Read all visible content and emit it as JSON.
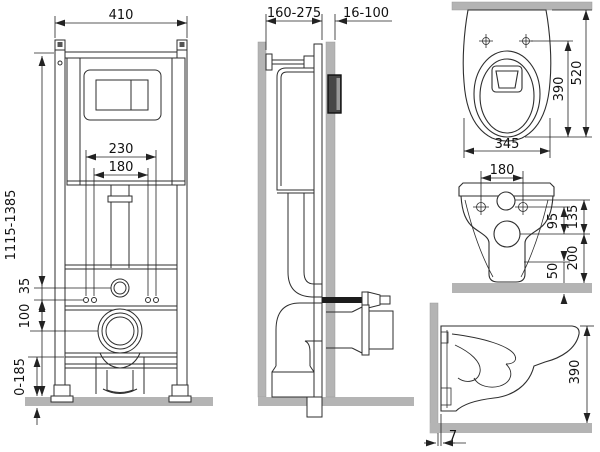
{
  "colors": {
    "line": "#2e2e2e",
    "dim_line": "#222222",
    "text": "#111111",
    "wall_fill": "#b4b4b4",
    "floor_fill": "#b4b4b4",
    "access_box_fill": "#474747",
    "access_box_highlight": "#9a9a9a",
    "background": "#ffffff"
  },
  "views": {
    "frame_front": {
      "dims": {
        "width": "410",
        "bolt_span_outer": "230",
        "bolt_span_inner": "180",
        "height_range": "1115-1385",
        "inlet_to_bolts": "35",
        "bolts_to_drain": "100",
        "foot_adjust": "0-185"
      }
    },
    "frame_side": {
      "dims": {
        "depth_range": "160-275",
        "facing_range": "16-100"
      }
    },
    "bowl_top": {
      "dims": {
        "length": "520",
        "holes_to_front": "390",
        "width": "345"
      }
    },
    "bowl_rear": {
      "dims": {
        "hole_spacing": "180",
        "inlet_drop": "135",
        "holes_drop": "95",
        "outlet_height": "200",
        "skirt_height": "50"
      }
    },
    "bowl_side": {
      "dims": {
        "height": "390",
        "wall_gap": "7"
      }
    }
  }
}
